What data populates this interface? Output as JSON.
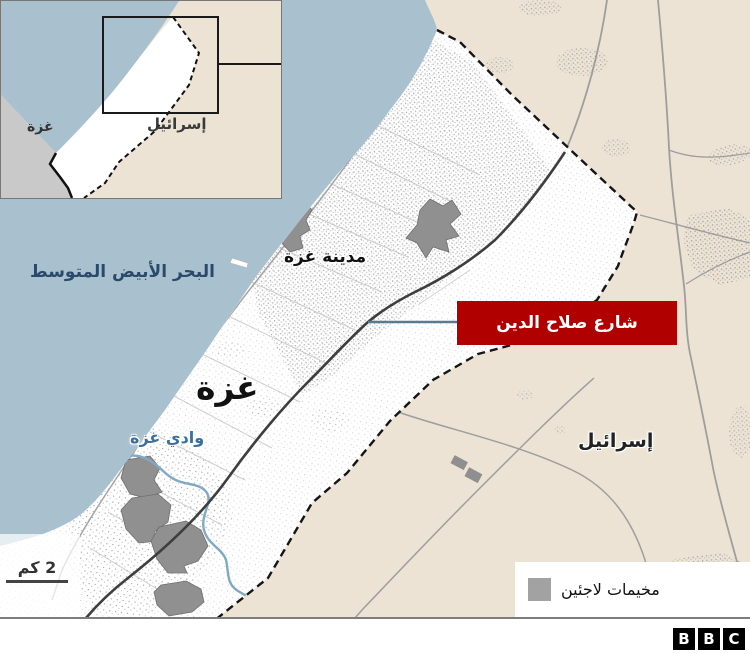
{
  "inset": {
    "gaza": "غزة",
    "israel": "إسرائيل"
  },
  "labels": {
    "sea": "البحر الأبيض المتوسط",
    "gaza_city": "مدينة غزة",
    "gaza": "غزة",
    "israel": "إسرائيل",
    "wadi": "وادي غزة",
    "road_callout": "شارع صلاح الدين"
  },
  "scale": {
    "label": "2 كم"
  },
  "legend": {
    "camps": "مخيمات لاجئين",
    "swatch_color": "#a2a2a2"
  },
  "footer": {
    "letters": [
      "B",
      "B",
      "C"
    ]
  },
  "colors": {
    "sea": "#a9c1cf",
    "land_israel": "#ece3d4",
    "gaza_strip": "#ffffff",
    "inset_secondary_land": "#c9c9c9",
    "callout_red": "#b00000",
    "refugee_camp_gray": "#909090",
    "main_road_dark": "#3e3e3e",
    "wadi_blue": "#7fa9c4"
  }
}
